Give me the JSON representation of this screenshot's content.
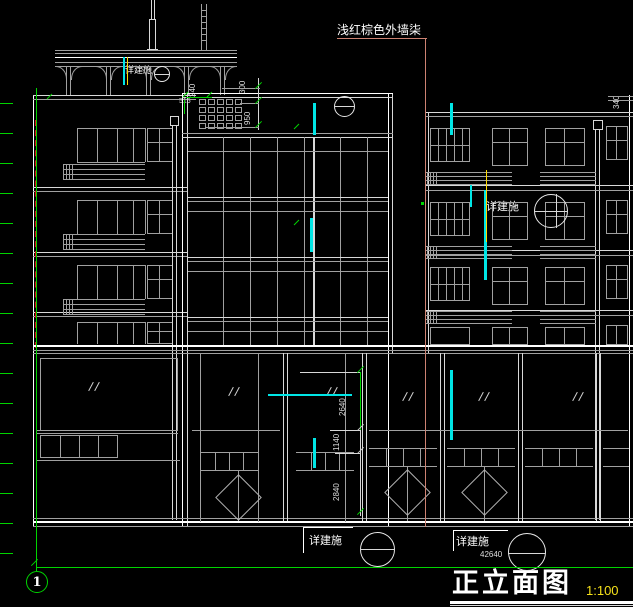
{
  "drawing": {
    "title": "正立面图",
    "scale": "1:100"
  },
  "annotations": {
    "wall_finish": "浅红棕色外墙柒",
    "detail_ref": "详建施",
    "axis_label": "1"
  },
  "dimensions": {
    "total_width": "42640",
    "top_upper": "300",
    "top_lower": "950",
    "crown_width": "240",
    "crown_offset": "515",
    "mid_upper": "2640",
    "mid_middle": "1140",
    "mid_lower": "2840",
    "right_edge": "340"
  },
  "colors": {
    "background": "#000000",
    "line_gray": "#a0a0a0",
    "line_bright": "#ffffff",
    "axis_green": "#00d400",
    "highlight_cyan": "#00e6e6",
    "highlight_yellow": "#ffd900",
    "leader_salmon": "#cd8272",
    "hidden_red": "#dd1111",
    "scale_yellow": "#f5e11a"
  }
}
